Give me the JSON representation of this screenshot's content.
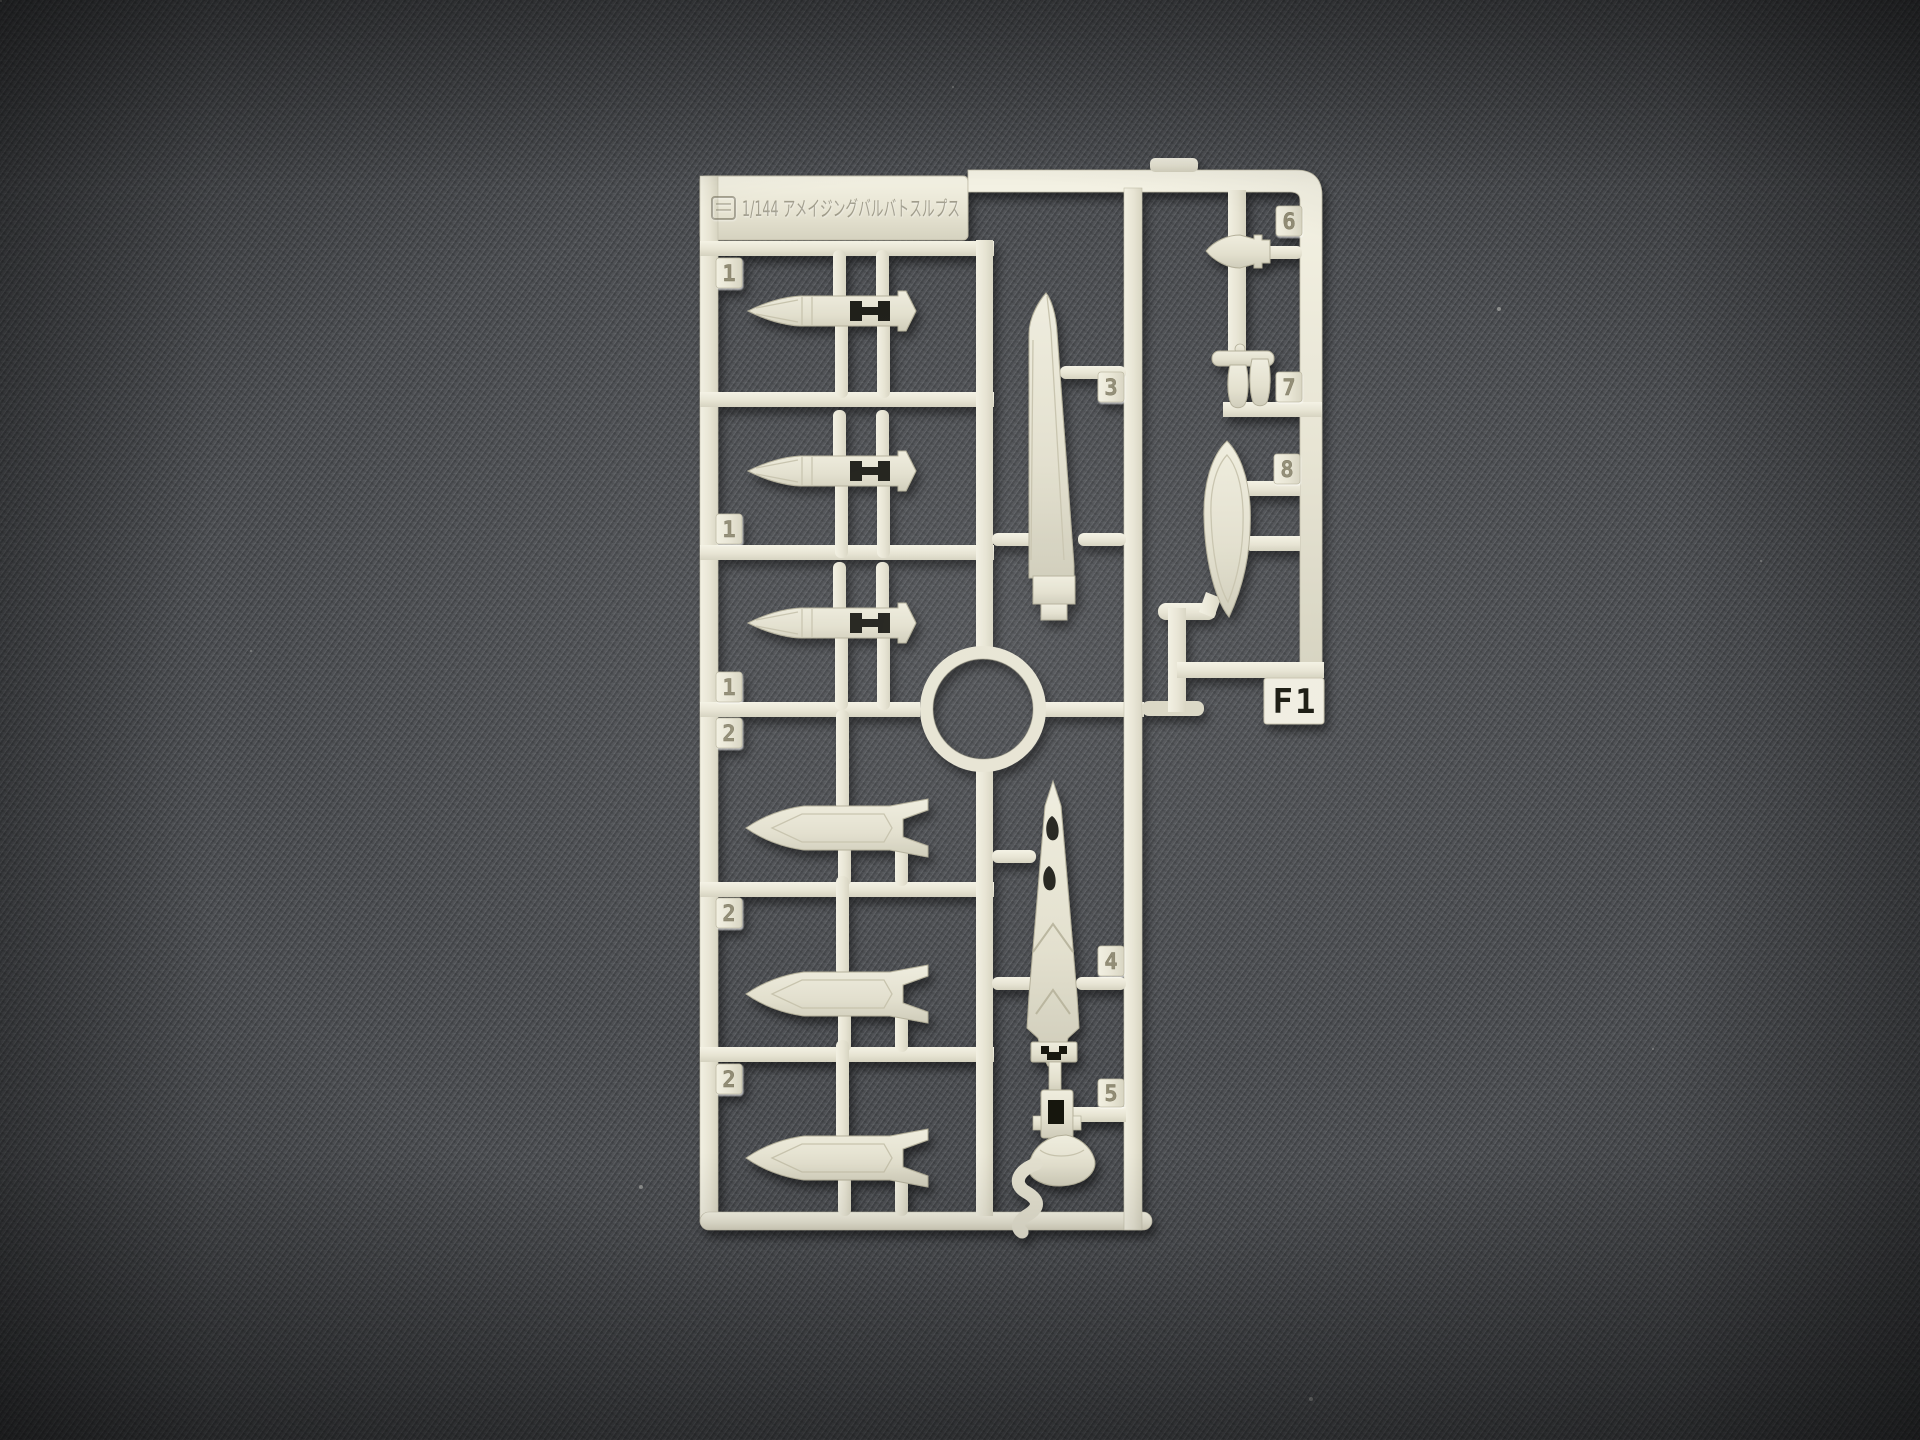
{
  "scene": {
    "background_color": "#4a4d51",
    "plastic_color": "#e9e6d5",
    "shadow_color": "#000000"
  },
  "sprue": {
    "title": "1/144 アメイジングバルバトスルプス",
    "gate_label": "F1",
    "number_tabs": [
      {
        "label": "1"
      },
      {
        "label": "1"
      },
      {
        "label": "1"
      },
      {
        "label": "2"
      },
      {
        "label": "2"
      },
      {
        "label": "2"
      },
      {
        "label": "3"
      },
      {
        "label": "4"
      },
      {
        "label": "5"
      },
      {
        "label": "6"
      },
      {
        "label": "7"
      },
      {
        "label": "8"
      }
    ]
  }
}
